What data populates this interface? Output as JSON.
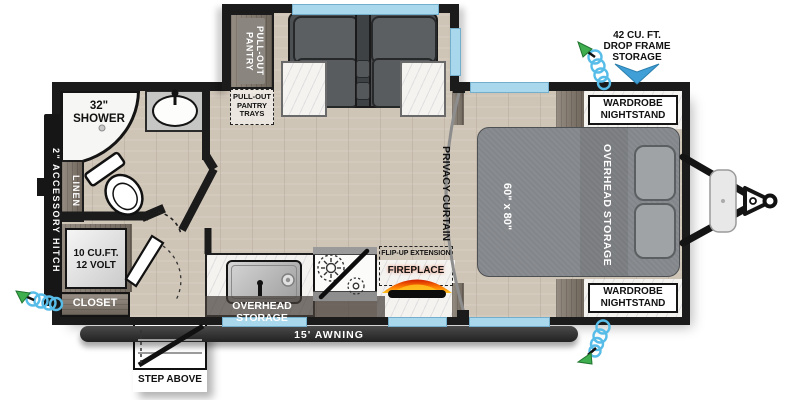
{
  "title": "Travel trailer floor plan",
  "labels": {
    "pantry": "PULL-OUT\nPANTRY",
    "pantry_trays": "PULL-OUT\nPANTRY\nTRAYS",
    "shower": "32\"\nSHOWER",
    "linen": "LINEN",
    "accessory_hitch": "2\" ACCESSORY HITCH",
    "fridge": "10 CU.FT.\n12 VOLT",
    "closet": "CLOSET",
    "kitchen_overhead": "OVERHEAD STORAGE",
    "awning": "15' AWNING",
    "step": "STEP ABOVE",
    "privacy_curtain": "PRIVACY CURTAIN",
    "flip_up": "FLIP-UP EXTENSION",
    "fireplace": "FIREPLACE",
    "bed_size": "60\" x 80\"",
    "bed_overhead": "OVERHEAD STORAGE",
    "wardrobe_front": "WARDROBE\nNIGHTSTAND",
    "wardrobe_rear": "WARDROBE\nNIGHTSTAND",
    "drop_frame": "42 CU. FT.\nDROP FRAME\nSTORAGE"
  },
  "colors": {
    "wall": "#1b1b1b",
    "window_glass": "#a9d7ec",
    "floor": "#cfc5b7",
    "marble": "#f4f3f0",
    "cabinet_wood": "#857b6f",
    "upholstery": "#54575a",
    "bed": "#83868a",
    "flame_orange": "#ff7a00",
    "hose_coil": "#57bde8",
    "hose_nozzle": "#3fae4e",
    "storage_arrow": "#3f9fd6",
    "awning_bar": "#333333"
  }
}
